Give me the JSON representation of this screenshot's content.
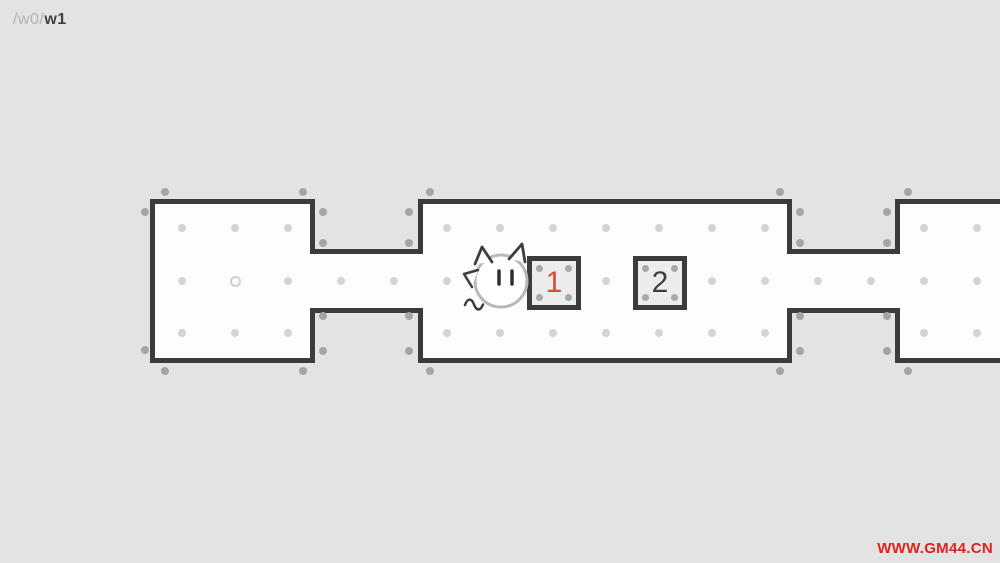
{
  "page": {
    "width": 1000,
    "height": 563,
    "background": "#e3e3e3"
  },
  "breadcrumb": {
    "prefix": "/w0/",
    "current": "w1",
    "prefix_color": "#b2b2b2",
    "current_color": "#3f3f3f"
  },
  "watermark": {
    "text": "WWW.GM44.CN",
    "color": "#e2211c"
  },
  "palette": {
    "wall": "#3b3b3b",
    "floor": "#fdfdfd",
    "inner_dot": "#d4d4d4",
    "outer_dot": "#a5a5a5",
    "ring": "#d0d0d0",
    "box_fill": "#ececec",
    "box_corner_dot": "#a8a8a8",
    "player_outline": "#b8b8b8",
    "detail_stroke": "#3d3d3d"
  },
  "level": {
    "rooms": [
      {
        "name": "left-room",
        "x": 150,
        "y": 199,
        "w": 165,
        "h": 164
      },
      {
        "name": "middle-room",
        "x": 418,
        "y": 199,
        "w": 374,
        "h": 164
      },
      {
        "name": "right-room",
        "x": 895,
        "y": 199,
        "w": 160,
        "h": 164
      }
    ],
    "corridors": [
      {
        "name": "corridor-1",
        "x": 310,
        "y": 249,
        "w": 113,
        "h": 64
      },
      {
        "name": "corridor-2",
        "x": 787,
        "y": 249,
        "w": 113,
        "h": 64
      }
    ],
    "inner_dots": [
      [
        182,
        228
      ],
      [
        235,
        228
      ],
      [
        288,
        228
      ],
      [
        182,
        281
      ],
      [
        288,
        281
      ],
      [
        182,
        333
      ],
      [
        235,
        333
      ],
      [
        288,
        333
      ],
      [
        341,
        281
      ],
      [
        394,
        281
      ],
      [
        447,
        228
      ],
      [
        500,
        228
      ],
      [
        553,
        228
      ],
      [
        606,
        228
      ],
      [
        659,
        228
      ],
      [
        712,
        228
      ],
      [
        765,
        228
      ],
      [
        447,
        281
      ],
      [
        606,
        281
      ],
      [
        712,
        281
      ],
      [
        765,
        281
      ],
      [
        447,
        333
      ],
      [
        500,
        333
      ],
      [
        553,
        333
      ],
      [
        606,
        333
      ],
      [
        659,
        333
      ],
      [
        712,
        333
      ],
      [
        765,
        333
      ],
      [
        818,
        281
      ],
      [
        871,
        281
      ],
      [
        924,
        228
      ],
      [
        977,
        228
      ],
      [
        924,
        281
      ],
      [
        977,
        281
      ],
      [
        924,
        333
      ],
      [
        977,
        333
      ]
    ],
    "outer_dots": [
      [
        165,
        192
      ],
      [
        303,
        192
      ],
      [
        430,
        192
      ],
      [
        780,
        192
      ],
      [
        908,
        192
      ],
      [
        145,
        212
      ],
      [
        145,
        350
      ],
      [
        323,
        212
      ],
      [
        323,
        243
      ],
      [
        409,
        212
      ],
      [
        409,
        243
      ],
      [
        323,
        316
      ],
      [
        323,
        351
      ],
      [
        409,
        316
      ],
      [
        409,
        351
      ],
      [
        800,
        212
      ],
      [
        800,
        243
      ],
      [
        887,
        212
      ],
      [
        887,
        243
      ],
      [
        800,
        316
      ],
      [
        800,
        351
      ],
      [
        887,
        316
      ],
      [
        887,
        351
      ],
      [
        165,
        371
      ],
      [
        303,
        371
      ],
      [
        430,
        371
      ],
      [
        780,
        371
      ],
      [
        908,
        371
      ]
    ],
    "ring_marker": {
      "x": 235,
      "y": 281
    }
  },
  "boxes": [
    {
      "label": "1",
      "x": 527,
      "y": 256,
      "size": 54,
      "label_color": "#d94a38"
    },
    {
      "label": "2",
      "x": 633,
      "y": 256,
      "size": 54,
      "label_color": "#3f3f3f"
    }
  ],
  "player": {
    "x": 501,
    "y": 281,
    "radius": 26,
    "type": "cat-face"
  }
}
